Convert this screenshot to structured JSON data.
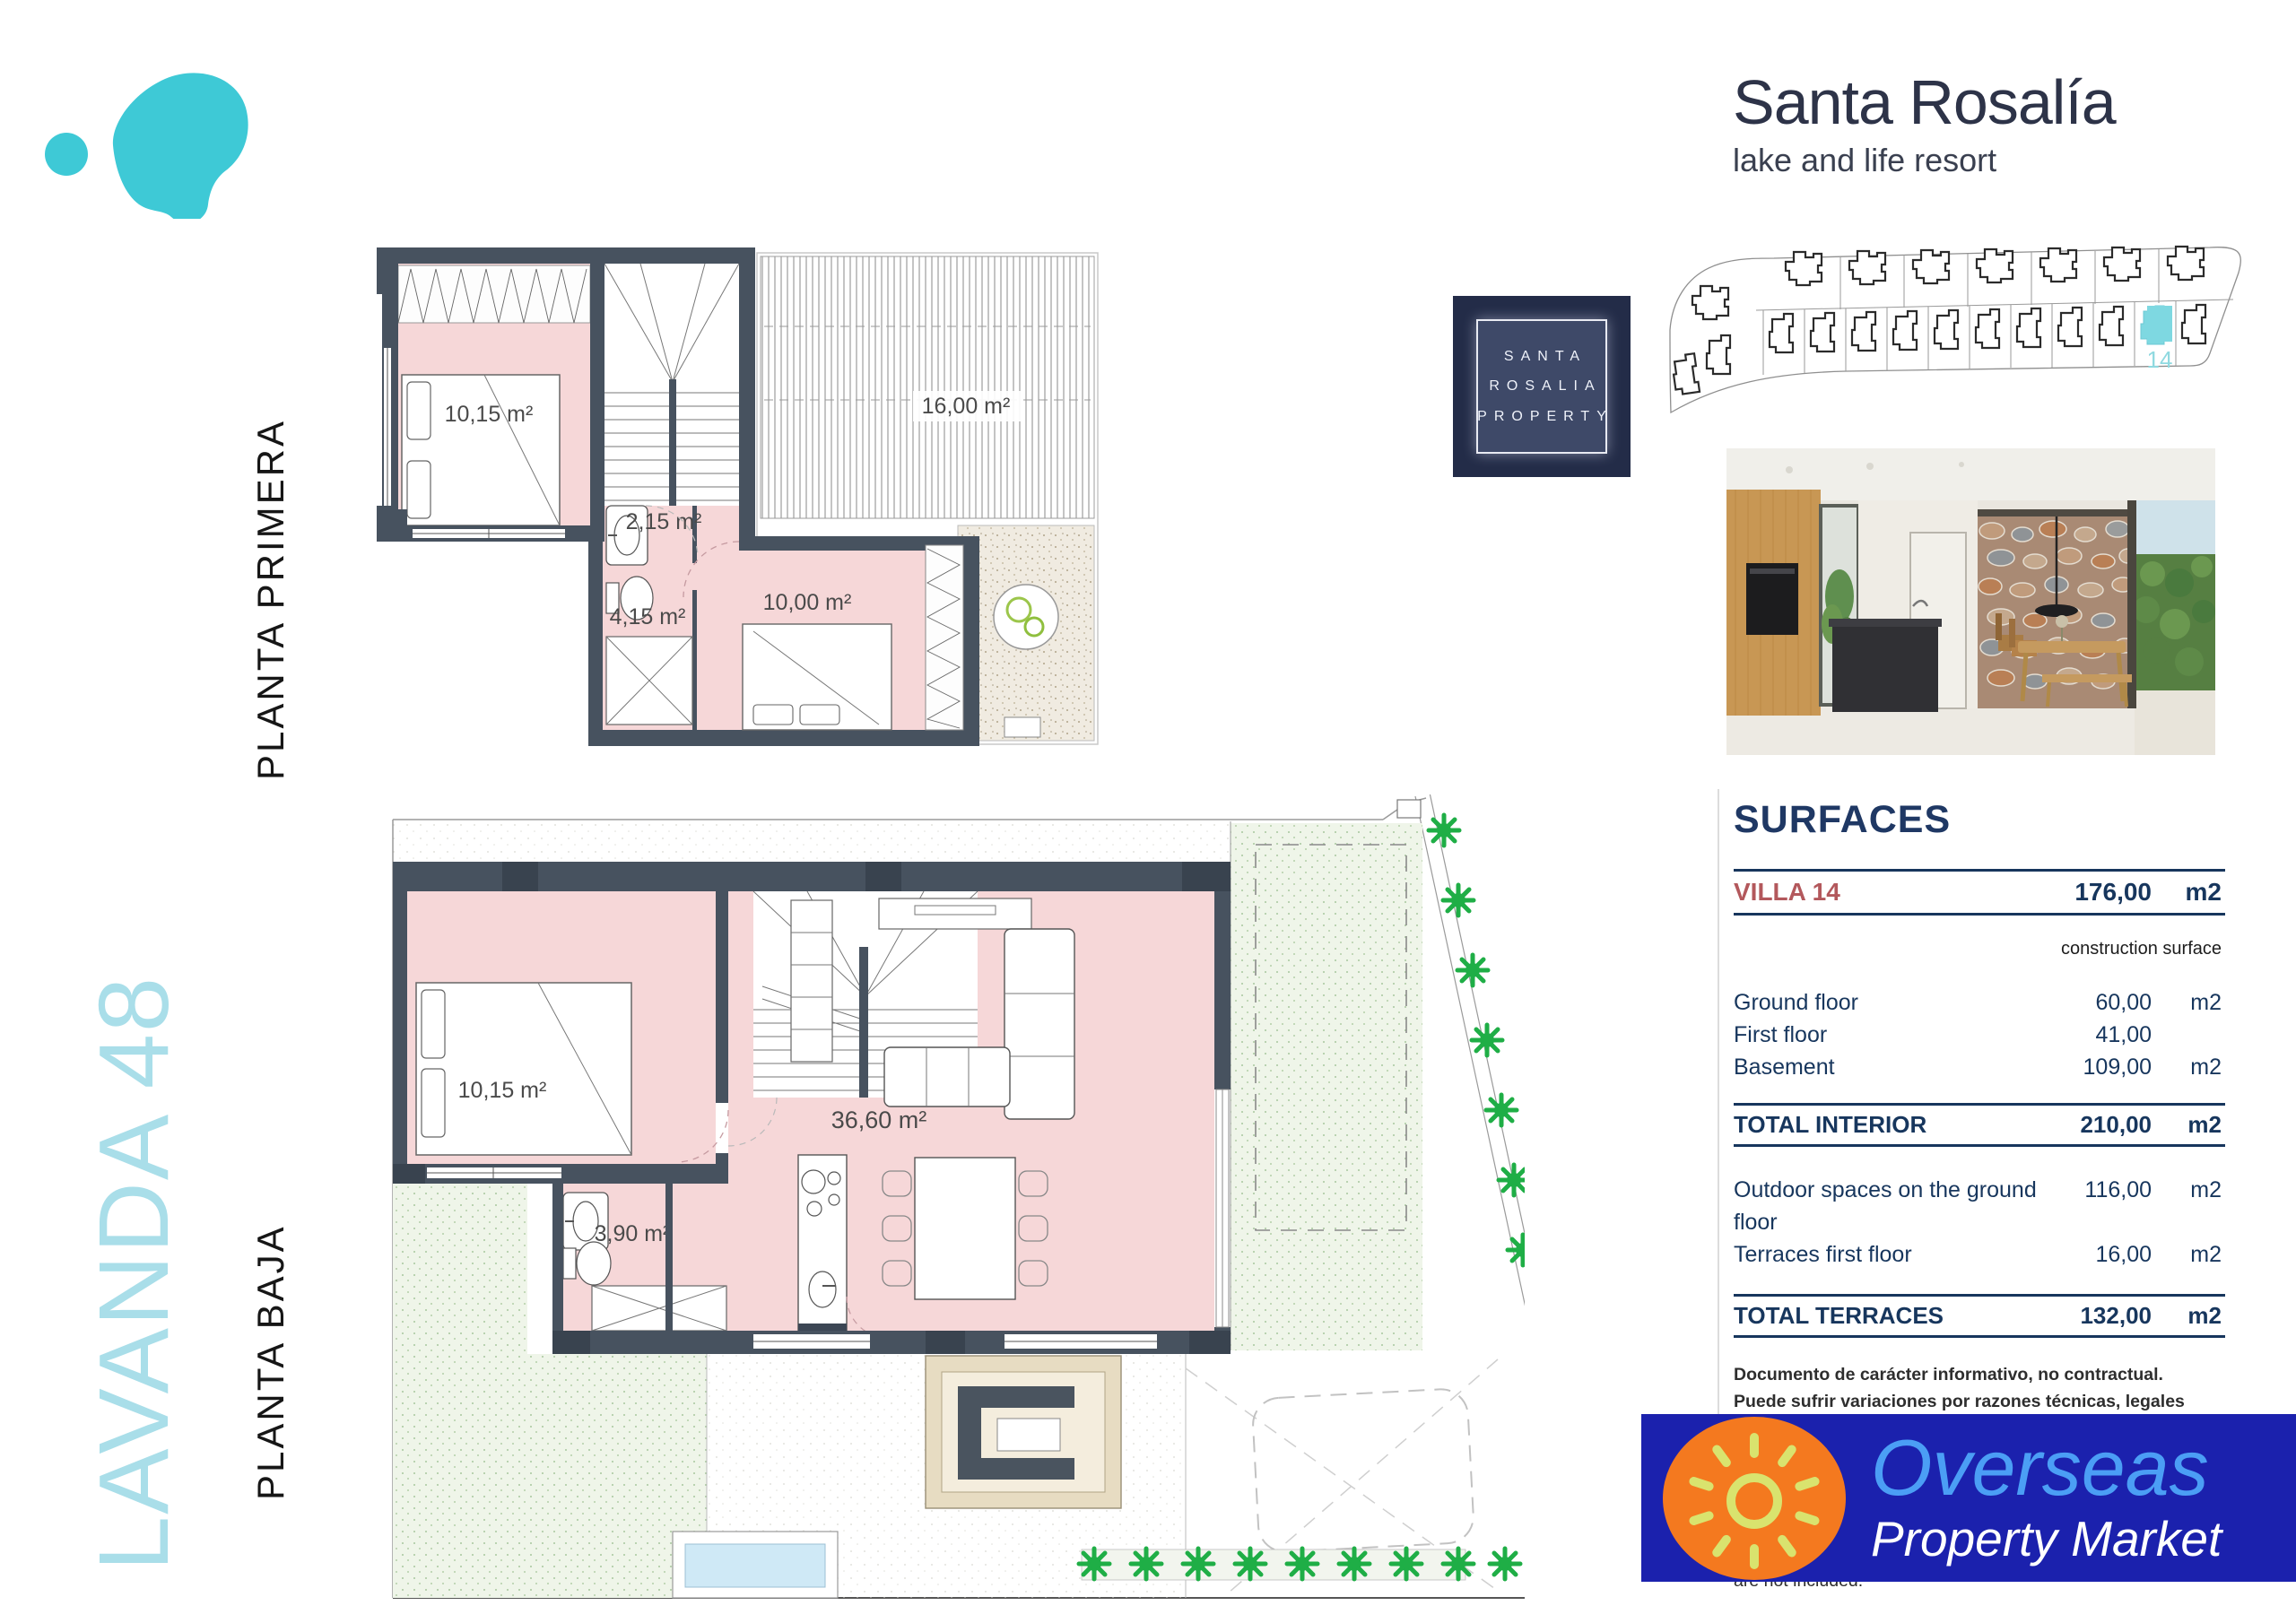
{
  "branding": {
    "resort_name": "Santa Rosalía",
    "resort_tagline": "lake and life resort",
    "property_box_lines": [
      "SANTA",
      "ROSALIA",
      "PROPERTY"
    ],
    "lake_logo_color": "#3EC9D6"
  },
  "project": {
    "name": "LAVANDA 48",
    "floor_upper_label": "PLANTA PRIMERA",
    "floor_ground_label": "PLANTA BAJA"
  },
  "site_plan": {
    "highlighted_unit": "14",
    "highlight_color": "#7ED8E1"
  },
  "floor_plans": {
    "planta_primera": {
      "bedroom1_area": "10,15 m²",
      "hall_area": "2,15 m²",
      "bathroom_area": "4,15 m²",
      "bedroom2_area": "10,00 m²",
      "terrace_area": "16,00 m²"
    },
    "planta_baja": {
      "bedroom_area": "10,15 m²",
      "living_area": "36,60 m²",
      "bathroom_area": "3,90 m²"
    }
  },
  "surfaces": {
    "title": "SURFACES",
    "villa": {
      "label": "VILLA 14",
      "value": "176,00",
      "unit": "m2"
    },
    "column_note": "construction surface",
    "rows": [
      {
        "label": "Ground floor",
        "value": "60,00",
        "unit": "m2"
      },
      {
        "label": "First floor",
        "value": "41,00",
        "unit": ""
      },
      {
        "label": "Basement",
        "value": "109,00",
        "unit": "m2"
      }
    ],
    "total_interior": {
      "label": "TOTAL INTERIOR",
      "value": "210,00",
      "unit": "m2"
    },
    "outdoor_rows": [
      {
        "label": "Outdoor spaces on the ground floor",
        "value": "116,00",
        "unit": "m2"
      },
      {
        "label": "Terraces first floor",
        "value": "16,00",
        "unit": "m2"
      }
    ],
    "total_terraces": {
      "label": "TOTAL TERRACES",
      "value": "132,00",
      "unit": "m2"
    },
    "disclaimer_es": "Documento de carácter informativo, no contractual. Puede sufrir variaciones por razones técnicas, legales o comerciales. El mobiliario y los electrodomésticos son decorativos y no están incluidos.",
    "disclaimer_en": "This plan is for illustration purposes only and may be modified for technical, legal or commercial reasons. The furniture and appliances shown are purrely decorative and are not included."
  },
  "footer": {
    "agency_name": "Overseas",
    "agency_subtitle": "Property Market"
  }
}
